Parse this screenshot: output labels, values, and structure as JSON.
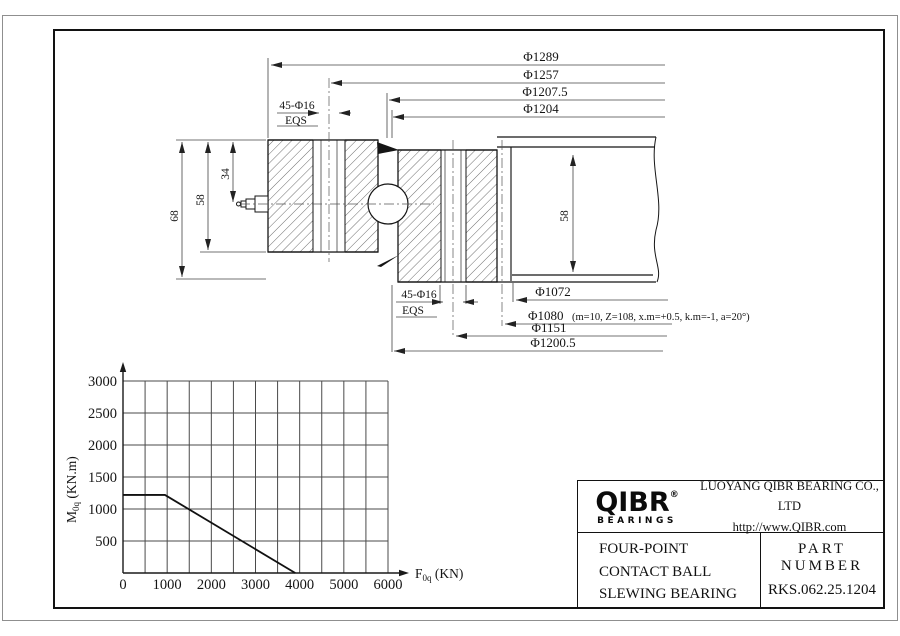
{
  "drawing": {
    "top_dims": [
      "Φ1289",
      "Φ1257",
      "Φ1207.5",
      "Φ1204"
    ],
    "bolt_top": {
      "size": "45-Φ16",
      "eqs": "EQS"
    },
    "bolt_bottom": {
      "size": "45-Φ16",
      "eqs": "EQS"
    },
    "heights": {
      "h68": "68",
      "h58": "58",
      "h34": "34",
      "plate58": "58"
    },
    "bottom_dims": {
      "d1072": "Φ1072",
      "d1080": "Φ1080",
      "d1080_note": "(m=10, Z=108, x.m=+0.5, k.m=-1, a=20°)",
      "d1151": "Φ1151",
      "d1200_5": "Φ1200.5"
    }
  },
  "chart_data": {
    "type": "line",
    "xlabel": {
      "main": "F",
      "sub": "0q",
      "unit": "(KN)"
    },
    "ylabel": {
      "main": "M",
      "sub": "0q",
      "unit": "(KN.m)"
    },
    "xlim": [
      0,
      6000
    ],
    "ylim": [
      0,
      3000
    ],
    "x_grid_step": 500,
    "y_grid_step": 500,
    "x_major_ticks": [
      0,
      1000,
      2000,
      3000,
      4000,
      5000,
      6000
    ],
    "y_major_ticks": [
      500,
      1000,
      1500,
      2000,
      2500,
      3000
    ],
    "grid": true,
    "series": [
      {
        "name": "static-limiting-load-curve",
        "points": [
          [
            0,
            1220
          ],
          [
            950,
            1220
          ],
          [
            3900,
            0
          ]
        ]
      }
    ]
  },
  "title_block": {
    "logo_text": "QIBR",
    "logo_reg": "®",
    "logo_sub": "BEARINGS",
    "company": "LUOYANG QIBR BEARING CO., LTD",
    "website": "http://www.QIBR.com",
    "product_lines": [
      "FOUR-POINT",
      "CONTACT BALL",
      "SLEWING BEARING"
    ],
    "part_number_label": "PART NUMBER",
    "part_number": "RKS.062.25.1204"
  }
}
